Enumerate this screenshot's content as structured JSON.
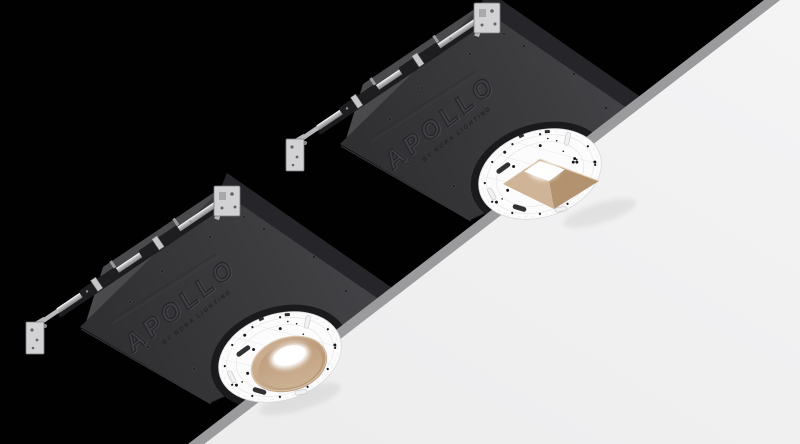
{
  "image": {
    "title": "Apollo by Nora Lighting recessed downlight housings mounted above a ceiling plane",
    "width": 800,
    "height": 444
  },
  "colors": {
    "bg": "#010101",
    "ceiling": "#f1f1f2",
    "ceilingEdge": "#9b9b9e",
    "pan": "#3b3b3e",
    "panDark": "#2f2f32",
    "panLight": "#47474b",
    "flange": "#4a4a4d",
    "sidewall": "#26262a",
    "collar": "#1a1a1c",
    "plate": "#fcfcfd",
    "plateLine": "#e6e6e8",
    "dot": "#19191b",
    "railLight": "#dddddf",
    "railMid": "#a8a8aa",
    "railDark": "#1e1e20",
    "bracket": "#d2d2d4",
    "bracketEdge": "#7e7e82",
    "trim": "#c2a284",
    "trimLight": "#d0b497",
    "trimDark": "#b3936f",
    "trimAlt": "#c8a98a",
    "trimRim": "#e7d8c2",
    "glow": "#ffffff",
    "embossDark": "#232327",
    "embossLight": "#54545a"
  },
  "fixtures": [
    {
      "id": "upper-fixture",
      "brand": "APOLLO",
      "tagline": "BY NORA LIGHTING",
      "trim_shape": "square",
      "description": "new-construction recessed housing with hanger bars, round mounting plate and square regressed trim"
    },
    {
      "id": "lower-fixture",
      "brand": "APOLLO",
      "tagline": "BY NORA LIGHTING",
      "trim_shape": "round",
      "description": "new-construction recessed housing with hanger bars, round mounting plate and round regressed trim"
    }
  ]
}
